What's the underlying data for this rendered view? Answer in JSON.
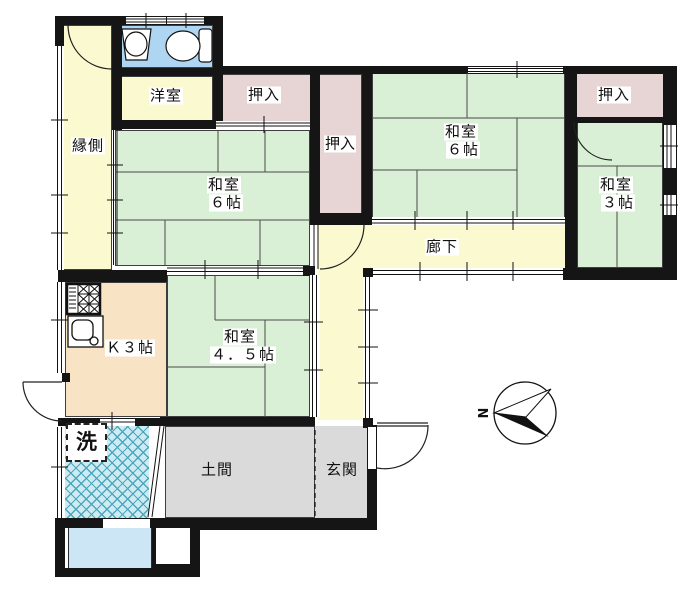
{
  "title": "floor-plan",
  "rooms": {
    "engawa": {
      "name": "縁側"
    },
    "youshitsu": {
      "name": "洋室"
    },
    "oshiire_top_left": {
      "name": "押入"
    },
    "oshiire_middle": {
      "name": "押入"
    },
    "oshiire_top_right": {
      "name": "押入"
    },
    "washitsu6_left": {
      "name": "和室",
      "size": "６帖"
    },
    "washitsu6_right": {
      "name": "和室",
      "size": "６帖"
    },
    "washitsu3": {
      "name": "和室",
      "size": "３帖"
    },
    "washitsu45": {
      "name": "和室",
      "size": "４．５帖"
    },
    "rouka": {
      "name": "廊下"
    },
    "kitchen": {
      "name": "Ｋ３帖"
    },
    "laundry": {
      "name": "洗"
    },
    "doma": {
      "name": "土間"
    },
    "genkan": {
      "name": "玄関"
    }
  },
  "compass": {
    "north": "N"
  },
  "colors": {
    "tatami_green": "#d9f0d7",
    "hallway_yellow": "#fbf9cf",
    "closet_pink": "#e7d4d4",
    "kitchen_peach": "#f8e3c5",
    "doma_gray": "#dadada",
    "toilet_blue": "#aed6f2",
    "bathtub_blue": "#cde6f5",
    "tile_blue": "#cfeaf2",
    "tile_line": "#49a8bc",
    "wall_black": "#151515"
  }
}
